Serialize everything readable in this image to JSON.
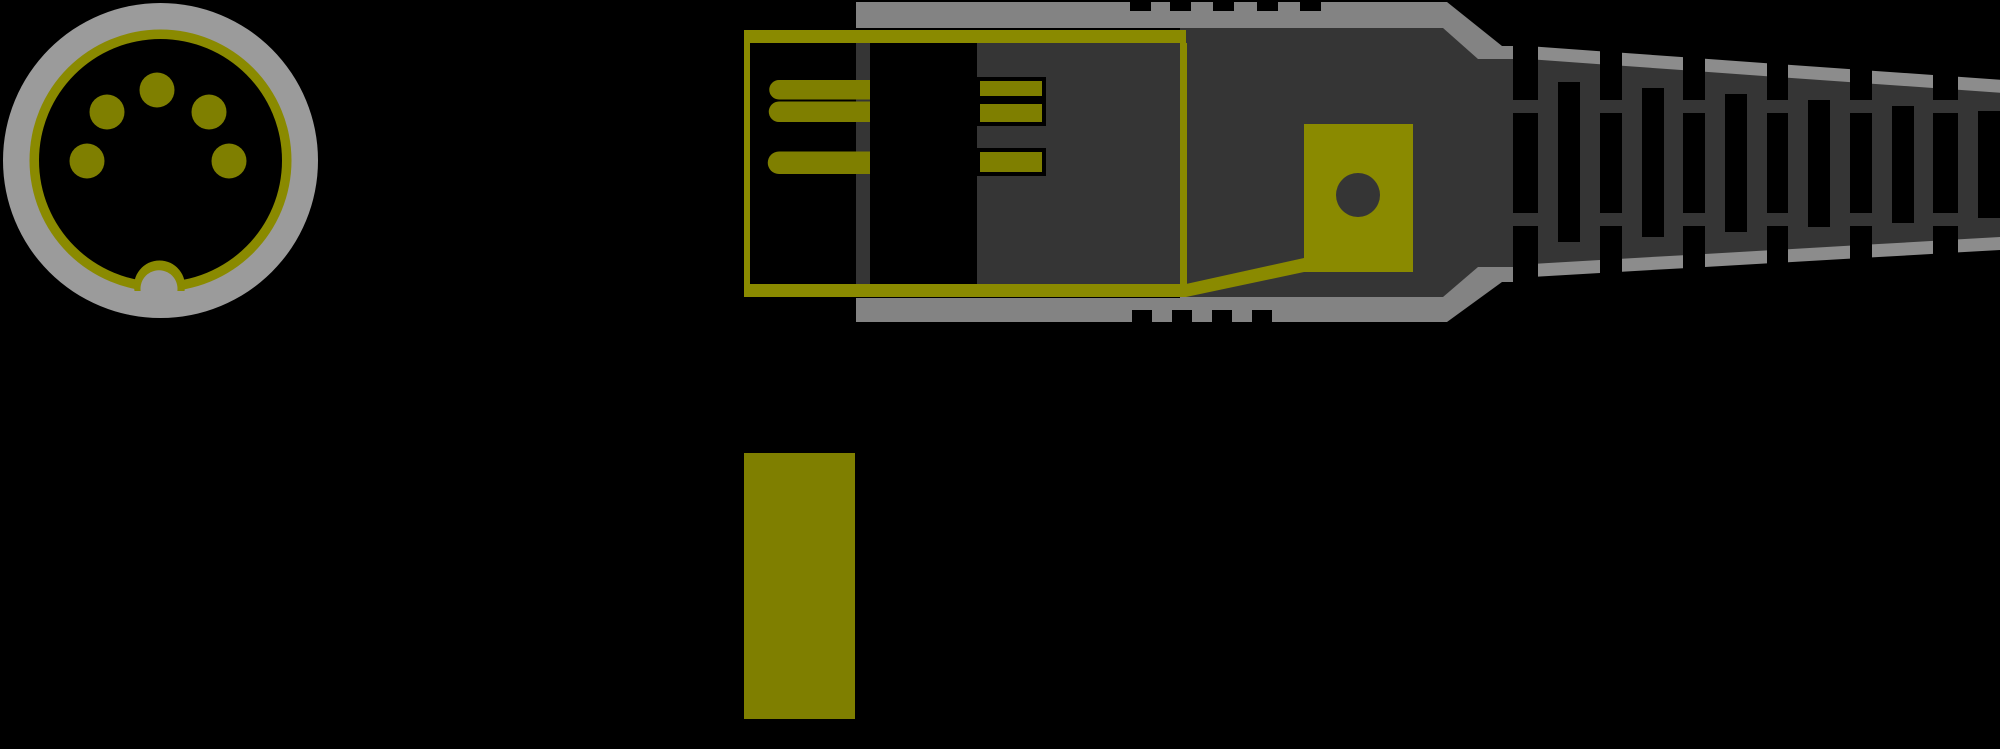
{
  "illustration": {
    "subject": "5-pin DIN plug",
    "views": {
      "front_view": {
        "name": "din-plug-front-view",
        "pin_count": 5,
        "has_keyway_notch": true
      },
      "side_view": {
        "name": "din-plug-side-cutaway-view",
        "left_pin_count": 3,
        "contact_bar_count": 3,
        "strain_relief_rib_count": 6,
        "top_grip_notch_count": 5,
        "bottom_grip_notch_count": 4,
        "has_cable_clamp_hole": true
      },
      "detail_block": {
        "name": "olive-detail-block",
        "shape": "rectangle"
      }
    }
  },
  "colors": {
    "black": "#000000",
    "dark_gray": "#353535",
    "shell_gray": "#838383",
    "cap_gray": "#8c8c8c",
    "ring_gray": "#9b9b9b",
    "olive": "#7f7f00",
    "olive_bright": "#8a8a00"
  }
}
